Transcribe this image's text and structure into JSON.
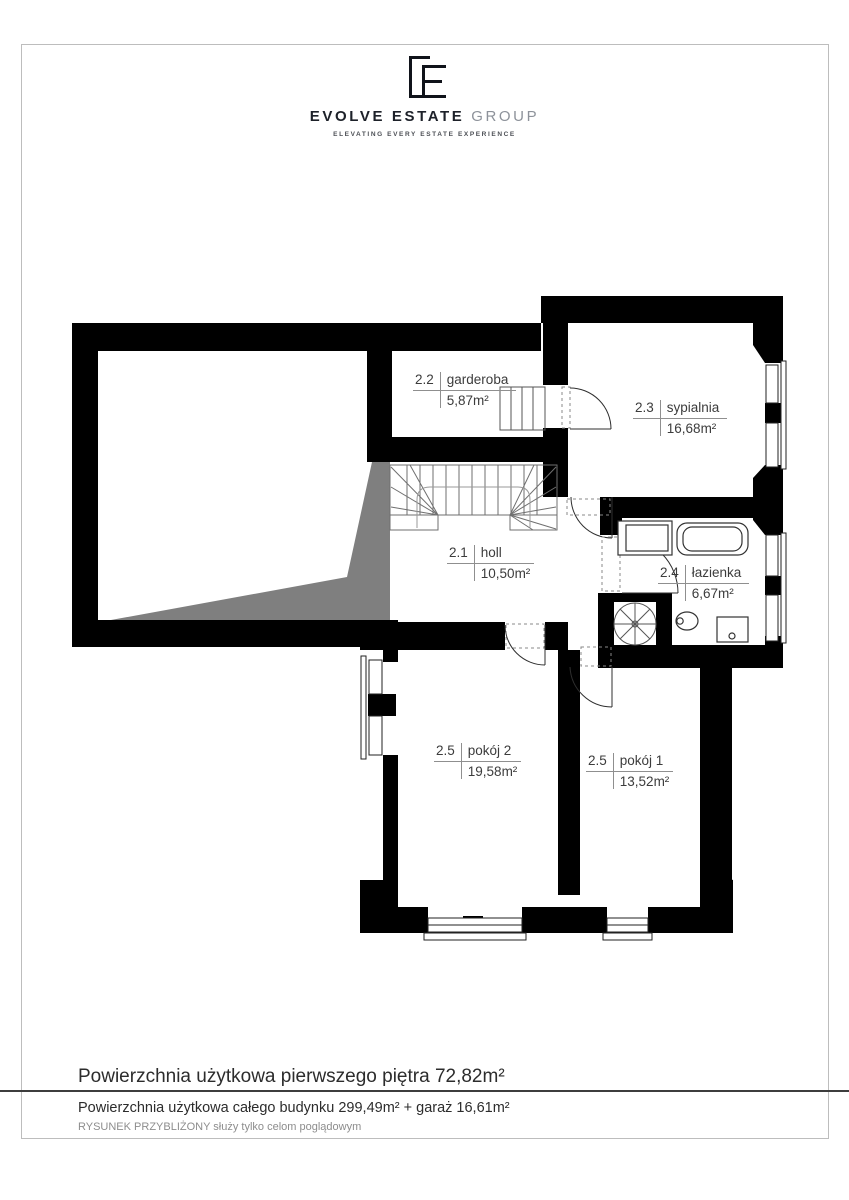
{
  "brand": {
    "name_primary": "EVOLVE ESTATE",
    "name_secondary": "GROUP",
    "tagline": "ELEVATING EVERY ESTATE EXPERIENCE"
  },
  "rooms": [
    {
      "id": "2.2",
      "name": "garderoba",
      "area": "5,87m²"
    },
    {
      "id": "2.3",
      "name": "sypialnia",
      "area": "16,68m²"
    },
    {
      "id": "2.1",
      "name": "holl",
      "area": "10,50m²"
    },
    {
      "id": "2.4",
      "name": "łazienka",
      "area": "6,67m²"
    },
    {
      "id": "2.5",
      "name": "pokój 2",
      "area": "19,58m²"
    },
    {
      "id": "2.5",
      "name": "pokój 1",
      "area": "13,52m²"
    }
  ],
  "footer": {
    "floor_area": "Powierzchnia użytkowa pierwszego piętra 72,82m²",
    "building_area": "Powierzchnia użytkowa całego budynku 299,49m² + garaż 16,61m²",
    "disclaimer": "RYSUNEK PRZYBLIŻONY służy tylko celom poglądowym"
  },
  "colors": {
    "wall": "#000000",
    "shadow": "#7f7f7f",
    "label_text": "#3c3c3c",
    "rule": "#8f8f8f"
  }
}
